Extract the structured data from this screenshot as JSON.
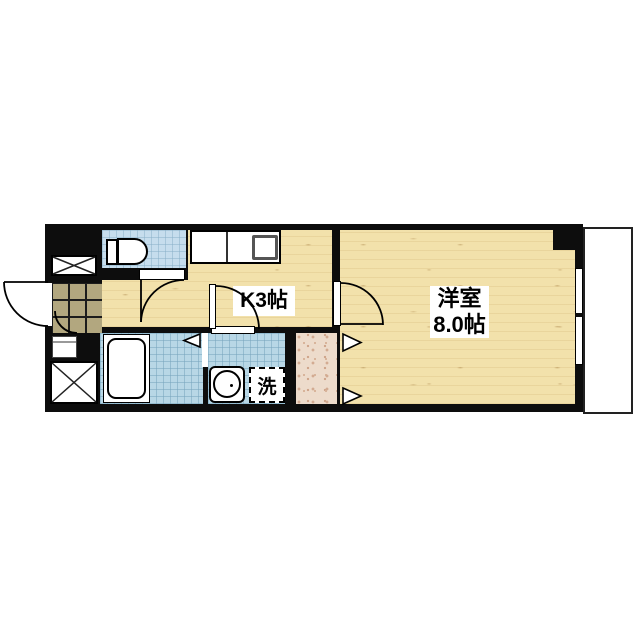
{
  "title": "1K apartment floor plan",
  "rooms": {
    "kitchen": {
      "label": "K3帖"
    },
    "western_room": {
      "name": "洋室",
      "size": "8.0帖"
    },
    "laundry": {
      "label": "洗"
    }
  },
  "fixtures": {
    "toilet": "toilet",
    "bathtub": "bathtub",
    "washbasin": "washbasin",
    "kitchen_counter": "kitchen-counter-with-sink",
    "shoe_box": "shoe-cabinet",
    "shaft_upper": "pipe-space-x-box",
    "shaft_lower": "pipe-space-x-box",
    "window": "sliding-window",
    "balcony": "balcony"
  },
  "colors": {
    "wall": "#0d0d0d",
    "wood_floor": "#f2e1ab",
    "wet_area_tile": "#b8d7e6",
    "toilet_tile": "#c6dded",
    "genkan_tile": "#b2a77f",
    "closet_floor": "#eddbcb",
    "balcony": "#ffffff",
    "line": "#000000"
  }
}
